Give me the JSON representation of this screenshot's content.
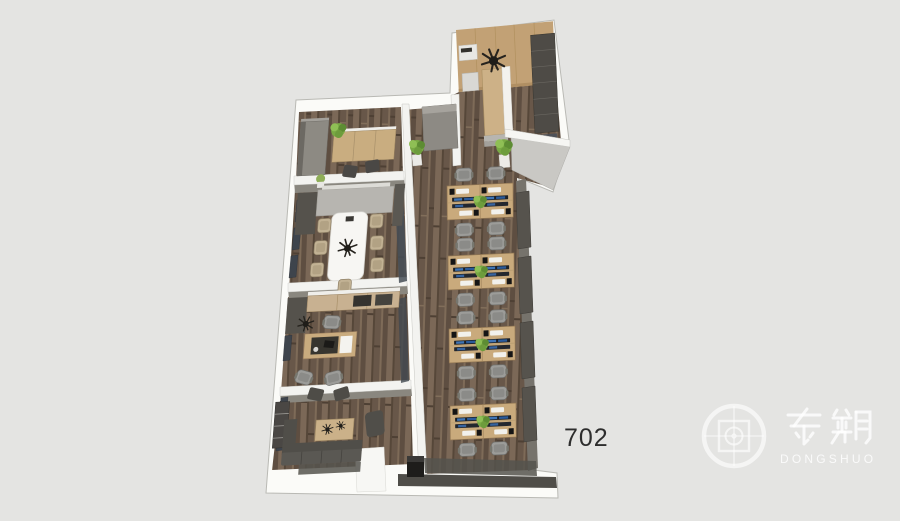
{
  "scene": {
    "background_color": "#e4e4e2",
    "unit_label": "702"
  },
  "watermark": {
    "brand_cn": "东朔",
    "brand_en": "DONGSHUO",
    "tint": "#ffffff"
  },
  "plan_palette": {
    "outer_wall": "#fbfbf8",
    "interior_wall": "#8a877f",
    "glass_window": "#3e444c",
    "wood_floor": "#6f5d4e",
    "desk_wood": "#c9aa7c",
    "panel_tan": "#c2a175",
    "conference_table": "#f7f6f3",
    "chair_gray": "#9c9c99",
    "chair_tan": "#c2b294",
    "sofa_gray": "#56544f",
    "plant_green": "#79a944",
    "monitor_dark": "#1c2026",
    "screen_blue": "#3f74b5"
  }
}
